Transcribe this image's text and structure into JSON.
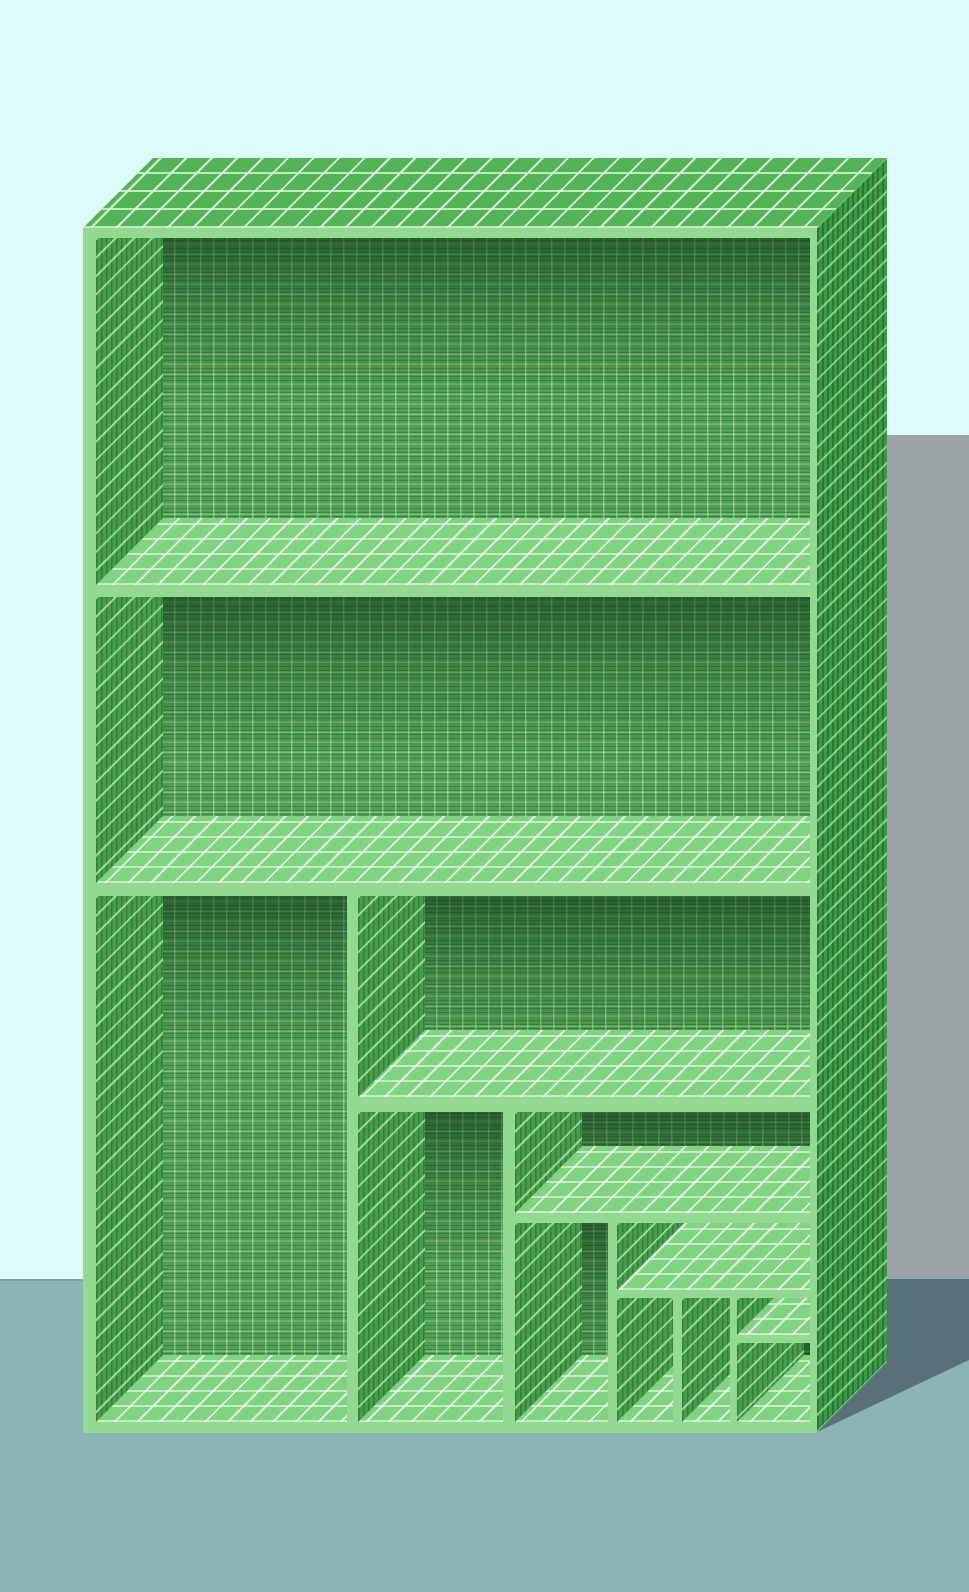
{
  "scene": {
    "title": "3D render of a green wireframe-textured shelf with recursively subdivided compartments, casting a gray shadow on a cyan wall and teal floor",
    "colors": {
      "wall": "#ddfcf9",
      "floor": "#8bb4b4",
      "floor-line": "#7aa3a4",
      "wall-shadow": "#9aa3a5",
      "floor-shadow": "#587179",
      "frame": "#92da92",
      "top-base": "#54b257",
      "side-base": "#3b9847",
      "back-base": "#4f9f54",
      "leftwall-base": "#459c4b",
      "floorstrip-base": "#80d381"
    },
    "layout": {
      "canvas": {
        "w": 969,
        "h": 1590
      },
      "floor_top": 1279,
      "wall_shadow": {
        "x": 887,
        "y": 435,
        "w": 82,
        "h": 844
      },
      "floor_shadow": {
        "x": 817,
        "y": 1279,
        "w": 152,
        "h": 153,
        "poly": "70px 0px, 152px 0px, 152px 81px, 0px 153px, 70px 83px"
      },
      "top_face": {
        "x": 83,
        "y": 158,
        "w": 804,
        "h": 70,
        "poly": "0px 70px, 734px 70px, 804px 0px, 70px 0px"
      },
      "side_face": {
        "x": 817,
        "y": 158,
        "w": 70,
        "h": 1274,
        "poly": "0px 70px, 70px 0px, 70px 1204px, 0px 1274px"
      },
      "front_face": {
        "x": 83,
        "y": 228,
        "w": 734,
        "h": 1205
      },
      "depth": 67,
      "compartments": [
        {
          "id": "top-shelf",
          "x": 13,
          "y": 10,
          "w": 714,
          "h": 347
        },
        {
          "id": "middle-shelf",
          "x": 13,
          "y": 369,
          "w": 714,
          "h": 286
        },
        {
          "id": "bottom-left-tall",
          "x": 13,
          "y": 668,
          "w": 251,
          "h": 526
        },
        {
          "id": "bottom-wide",
          "x": 275,
          "y": 668,
          "w": 452,
          "h": 201
        },
        {
          "id": "middle-column",
          "x": 275,
          "y": 884,
          "w": 145,
          "h": 310
        },
        {
          "id": "nested-wide",
          "x": 432,
          "y": 884,
          "w": 295,
          "h": 101
        },
        {
          "id": "nested-column-1",
          "x": 432,
          "y": 995,
          "w": 93,
          "h": 199
        },
        {
          "id": "nested-shallow",
          "x": 534,
          "y": 995,
          "w": 193,
          "h": 67
        },
        {
          "id": "nested-column-2",
          "x": 534,
          "y": 1070,
          "w": 56,
          "h": 124
        },
        {
          "id": "nested-column-3",
          "x": 599,
          "y": 1070,
          "w": 48,
          "h": 124
        },
        {
          "id": "nested-small-top",
          "x": 654,
          "y": 1070,
          "w": 73,
          "h": 37
        },
        {
          "id": "nested-small-bottom",
          "x": 654,
          "y": 1115,
          "w": 73,
          "h": 79
        }
      ]
    }
  }
}
